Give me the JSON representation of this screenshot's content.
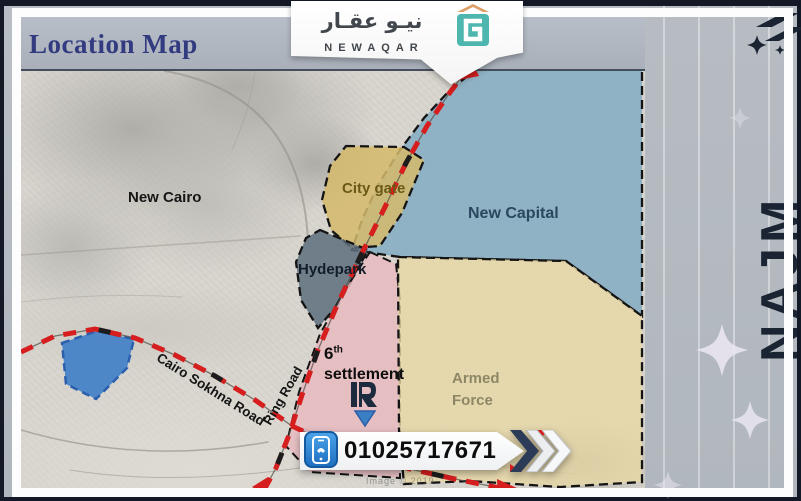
{
  "title": "Location Map",
  "logo": {
    "arabic": "نيـو عقـار",
    "latin": "NEWAQAR"
  },
  "brand": {
    "vertical": "NAJM"
  },
  "labels": {
    "new_cairo": "New Cairo",
    "city_gate": "City gate",
    "new_capital": "New Capital",
    "hydepark": "Hydepark",
    "settlement_num": "6",
    "settlement_sup": "th",
    "settlement_word": "settlement",
    "armed_line1": "Armed",
    "armed_line2": "Force",
    "road_sokhna": "Cairo Sokhna Road",
    "road_ring": "Ring Road",
    "watermark": "Image © 2019"
  },
  "contact": {
    "phone": "01025717671"
  },
  "colors": {
    "new_capital_fill": "#7fa9c2",
    "city_gate_fill": "#d5ba6b",
    "hydepark_fill": "#5d6f7d",
    "settlement_fill": "#e8b9bf",
    "armed_force_fill": "#e8d8a6",
    "lake_fill": "#3f7ec7",
    "road_red": "#d61e1e",
    "title_navy": "#333b80",
    "brand_dark": "#1b2433",
    "logo_teal": "#4db6ae",
    "phone_blue": "#2e86d4"
  }
}
